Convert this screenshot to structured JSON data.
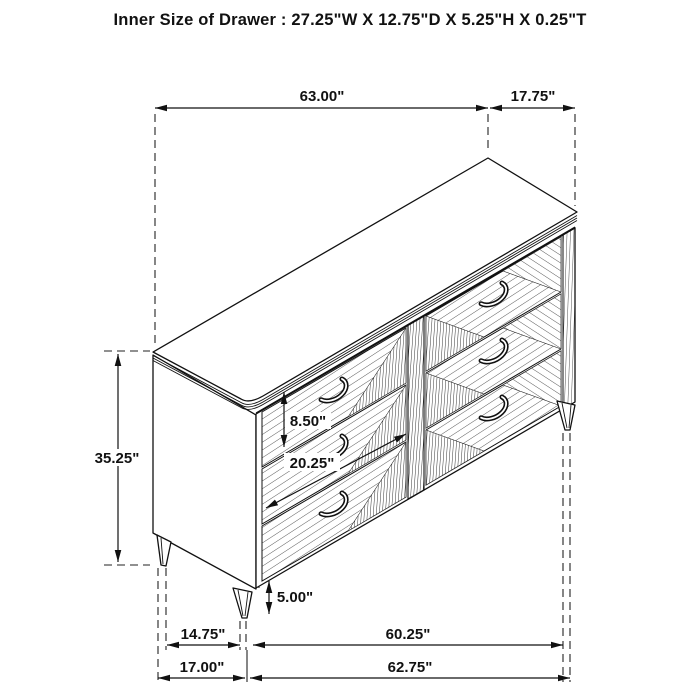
{
  "title": "Inner Size of Drawer : 27.25\"W X 12.75\"D X 5.25\"H X 0.25\"T",
  "diagram_type": "dresser-dimension-line-drawing",
  "colors": {
    "line": "#111111",
    "background": "#ffffff"
  },
  "dimensions": {
    "top_width": "63.00\"",
    "top_depth": "17.75\"",
    "overall_height": "35.25\"",
    "drawer_front_height": "8.50\"",
    "drawer_front_width": "20.25\"",
    "leg_height": "5.00\"",
    "base_inner_depth": "14.75\"",
    "base_inner_width": "60.25\"",
    "base_depth": "17.00\"",
    "base_width": "62.75\""
  }
}
